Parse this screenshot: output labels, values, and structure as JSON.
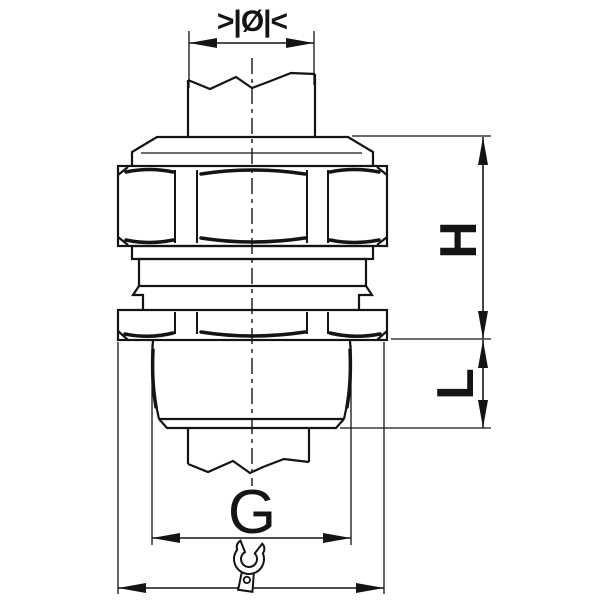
{
  "drawing": {
    "labels": {
      "cable_diameter": ">|Ø|<",
      "height": "H",
      "length": "L",
      "thread_size": "G"
    },
    "icons": {
      "wrench": "wrench-icon"
    },
    "colors": {
      "line": "#141414",
      "background": "#ffffff"
    }
  }
}
